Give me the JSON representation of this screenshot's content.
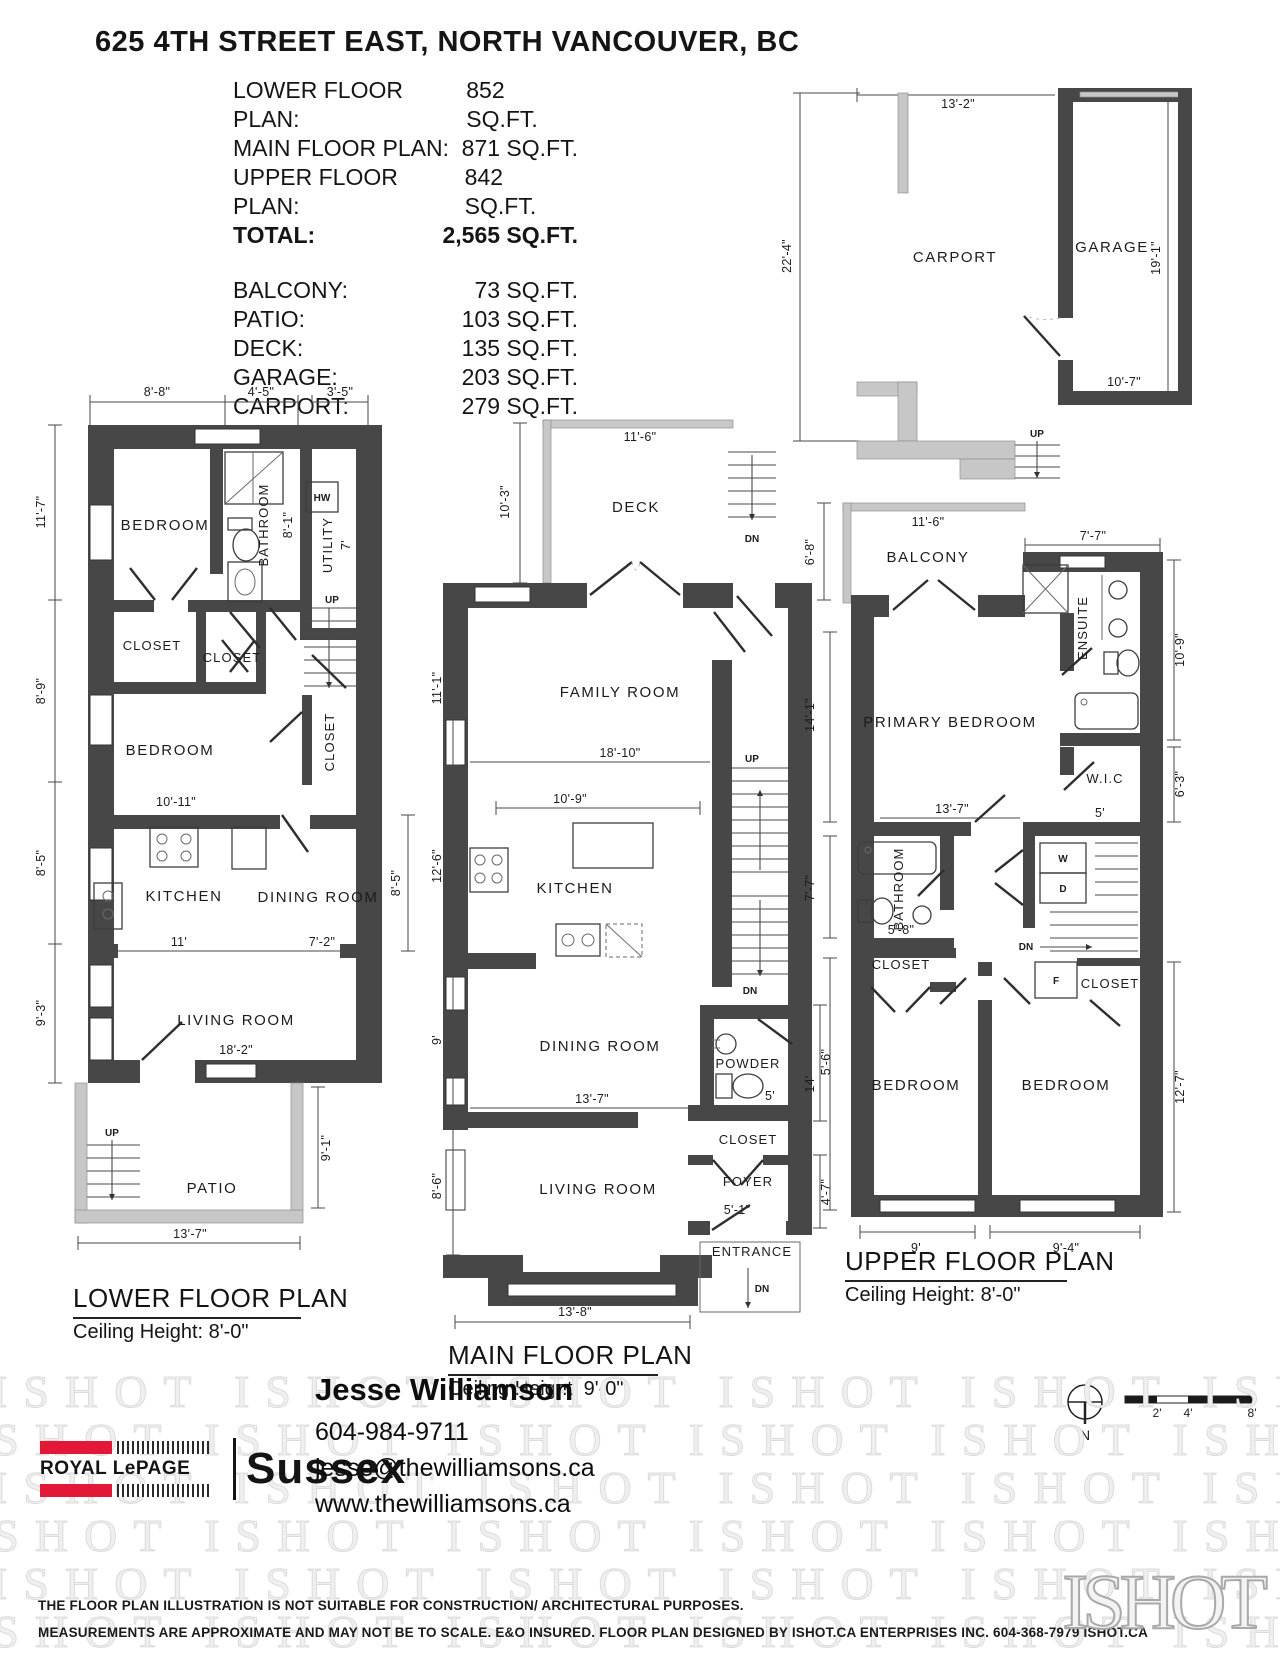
{
  "header": {
    "title": "625 4TH STREET EAST, NORTH VANCOUVER, BC",
    "floor_areas": [
      {
        "label": "LOWER FLOOR PLAN:",
        "value": "852 SQ.FT."
      },
      {
        "label": "MAIN FLOOR PLAN:",
        "value": "871 SQ.FT."
      },
      {
        "label": "UPPER FLOOR PLAN:",
        "value": "842 SQ.FT."
      },
      {
        "label": "TOTAL:",
        "value": "2,565 SQ.FT."
      }
    ],
    "other_areas": [
      {
        "label": "BALCONY:",
        "value": "73 SQ.FT."
      },
      {
        "label": "PATIO:",
        "value": "103 SQ.FT."
      },
      {
        "label": "DECK:",
        "value": "135 SQ.FT."
      },
      {
        "label": "GARAGE:",
        "value": "203 SQ.FT."
      },
      {
        "label": "CARPORT:",
        "value": "279 SQ.FT."
      }
    ]
  },
  "garage_plan": {
    "carport_label": "CARPORT",
    "garage_label": "GARAGE",
    "dim_top": "13'-2\"",
    "dim_left": "22'-4\"",
    "dim_bottom": "10'-7\"",
    "dim_right": "19'-1\"",
    "up_label": "UP"
  },
  "lower_plan": {
    "title": "LOWER FLOOR PLAN",
    "ceiling": "Ceiling Height: 8'-0\"",
    "rooms": {
      "bedroom1": "BEDROOM",
      "bathroom": "BATHROOM",
      "bathroom_dim": "8'-1\"",
      "utility": "UTILITY",
      "utility_dim": "7'",
      "hw": "HW",
      "closet1": "CLOSET",
      "closet2": "CLOSET",
      "closet3": "CLOSET",
      "bedroom2": "BEDROOM",
      "bedroom2_dim": "10'-11\"",
      "kitchen": "KITCHEN",
      "dining": "DINING ROOM",
      "kitchen_dim": "11'",
      "dining_dim": "7'-2\"",
      "living": "LIVING ROOM",
      "living_dim": "18'-2\"",
      "patio": "PATIO",
      "up1": "UP",
      "up2": "UP"
    },
    "dims": {
      "top1": "8'-8\"",
      "top2": "4'-5\"",
      "top3": "3'-5\"",
      "left1": "11'-7\"",
      "left2": "8'-9\"",
      "left3": "8'-5\"",
      "left4": "9'-3\"",
      "right1": "8'-5\"",
      "right2": "9'-1\"",
      "bottom": "13'-7\""
    }
  },
  "main_plan": {
    "title": "MAIN FLOOR PLAN",
    "ceiling": "Ceiling Height: 9'-0\"",
    "rooms": {
      "deck": "DECK",
      "deck_w": "11'-6\"",
      "deck_h": "10'-3\"",
      "family": "FAMILY ROOM",
      "family_w": "18'-10\"",
      "kitchen": "KITCHEN",
      "kitchen_w": "10'-9\"",
      "dining": "DINING ROOM",
      "dining_w": "13'-7\"",
      "powder": "POWDER",
      "powder_w": "5'",
      "closet": "CLOSET",
      "foyer": "FOYER",
      "foyer_w": "5'-1\"",
      "living": "LIVING ROOM",
      "entrance": "ENTRANCE",
      "up": "UP",
      "dn_deck": "DN",
      "dn_stairs": "DN",
      "dn_entry": "DN"
    },
    "dims": {
      "left1": "11'-1\"",
      "left2": "12'-6\"",
      "left3": "9'",
      "left4": "8'-6\"",
      "right1": "5'-6\"",
      "right2": "4'-7\"",
      "bottom": "13'-8\""
    }
  },
  "upper_plan": {
    "title": "UPPER FLOOR PLAN",
    "ceiling": "Ceiling Height: 8'-0\"",
    "rooms": {
      "balcony": "BALCONY",
      "balcony_w": "11'-6\"",
      "ensuite": "ENSUITE",
      "primary": "PRIMARY BEDROOM",
      "primary_w": "13'-7\"",
      "wic": "W.I.C",
      "wic_w": "5'",
      "bathroom": "BATHROOM",
      "bathroom_w": "5'-8\"",
      "washer": "W",
      "dryer": "D",
      "furnace": "F",
      "closet1": "CLOSET",
      "closet2": "CLOSET",
      "bedroom1": "BEDROOM",
      "bedroom1_w": "9'",
      "bedroom2": "BEDROOM",
      "bedroom2_w": "9'-4\"",
      "dn": "DN"
    },
    "dims": {
      "top_right": "7'-7\"",
      "left1": "6'-8\"",
      "left2": "14'-1\"",
      "left3": "7'-7\"",
      "left4": "14'",
      "right1": "10'-9\"",
      "right2": "6'-3\"",
      "right3": "12'-7\""
    }
  },
  "legend": {
    "north": "N",
    "scale_ticks": [
      "2'",
      "4'",
      "8'"
    ]
  },
  "footer": {
    "brand_line1": "ROYAL LePAGE",
    "brand_line2": "Sussex",
    "agent_name": "Jesse Williamson",
    "agent_phone": "604-984-9711",
    "agent_email": "jesse@thewilliamsons.ca",
    "agent_website": "www.thewilliamsons.ca",
    "watermark_text": "ISHOT"
  },
  "disclaimer": {
    "line1": "THE FLOOR PLAN ILLUSTRATION IS NOT SUITABLE FOR CONSTRUCTION/ ARCHITECTURAL PURPOSES.",
    "line2": "MEASUREMENTS ARE APPROXIMATE AND MAY NOT BE TO SCALE. E&O INSURED. FLOOR PLAN DESIGNED BY ISHOT.CA ENTERPRISES INC. 604-368-7979  ISHOT.CA",
    "logo": "ISHOT"
  }
}
